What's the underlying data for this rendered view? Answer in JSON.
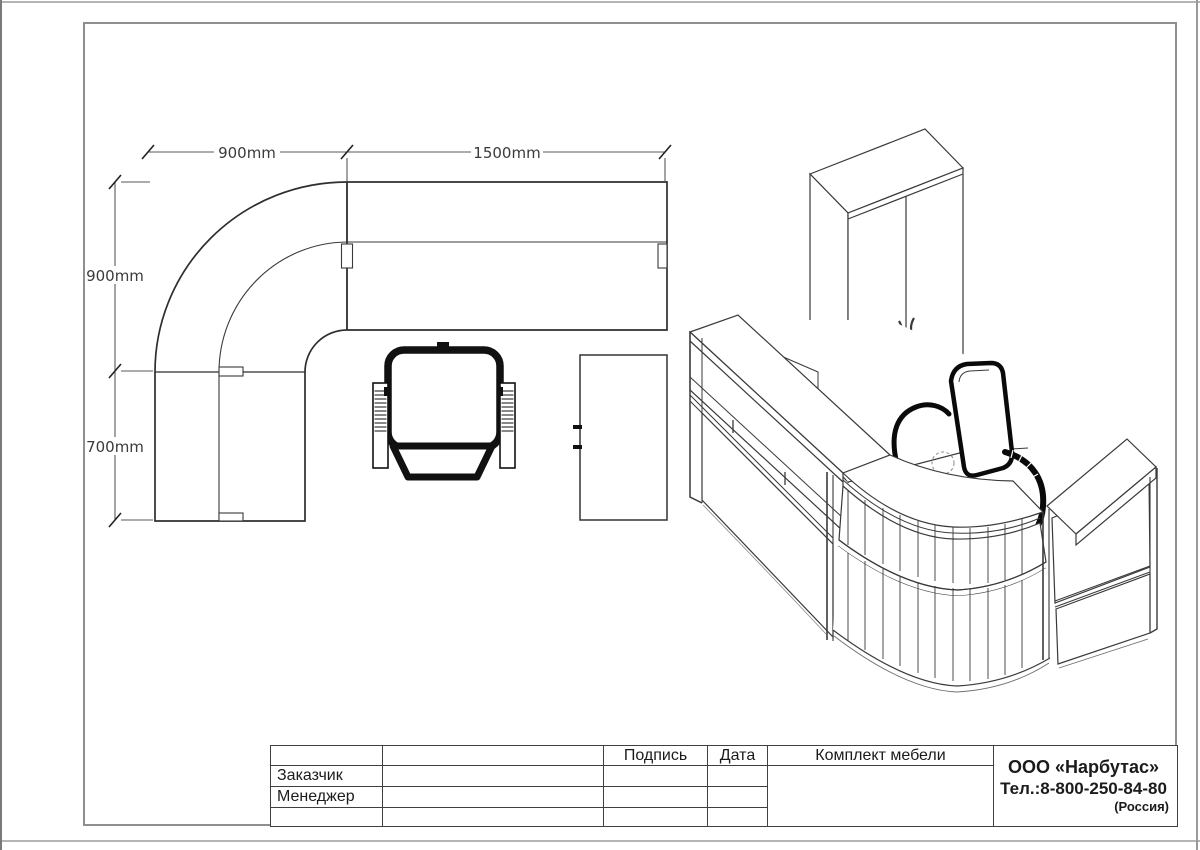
{
  "page": {
    "background": "#ffffff",
    "line_color": "#3a3a3a",
    "frame_color": "#8f8f8f",
    "chair_black": "#0d0d0d"
  },
  "plan": {
    "dim_top_left": "900mm",
    "dim_top_right": "1500mm",
    "dim_left_upper": "900mm",
    "dim_left_lower": "700mm"
  },
  "title_block": {
    "signature_header": "Подпись",
    "date_header": "Дата",
    "customer_label": "Заказчик",
    "manager_label": "Менеджер",
    "set_header": "Комплект мебели",
    "company_name": "ООО «Нарбутас»",
    "company_phone": "Тел.:8-800-250-84-80",
    "company_country": "(Россия)"
  }
}
